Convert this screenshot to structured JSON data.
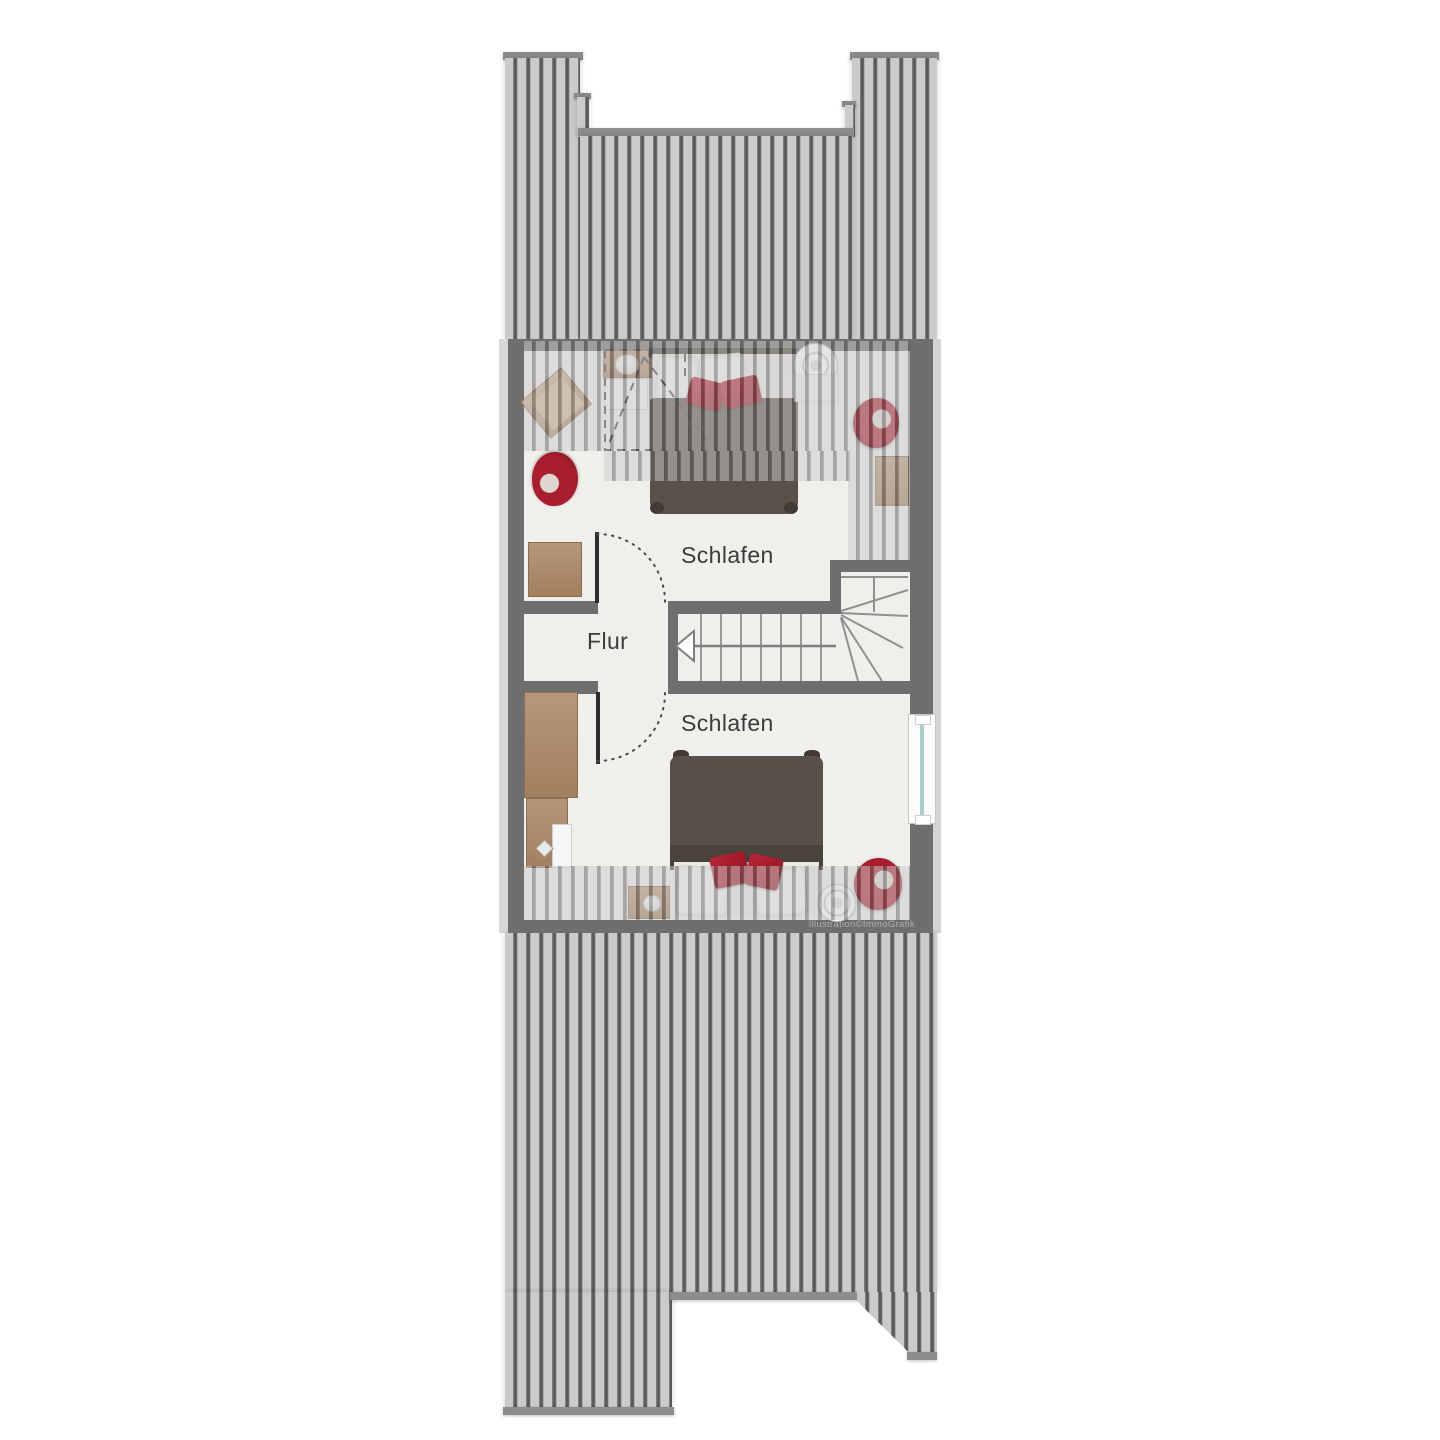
{
  "floorplan": {
    "type": "attic-floor-plan",
    "rooms": [
      {
        "id": "bedroom-top",
        "label": "Schlafen"
      },
      {
        "id": "hallway",
        "label": "Flur"
      },
      {
        "id": "bedroom-bottom",
        "label": "Schlafen"
      }
    ],
    "stair": {
      "direction_arrow": "left",
      "style": "straight-run-with-winder"
    },
    "watermark": "Illustration©ImmoGrafik",
    "colors": {
      "roof_stripe_light": "#cccbcb",
      "roof_stripe_dark": "#595959",
      "roof_cap": "#8d8d8d",
      "wall": "#6e6e6e",
      "floor": "#f0efec",
      "wood": "#a8876a",
      "bed_dark": "#574f48",
      "accent_red": "#a81e2e",
      "window_glass": "#a9cdcb",
      "label_text": "#3b3b3b"
    }
  }
}
